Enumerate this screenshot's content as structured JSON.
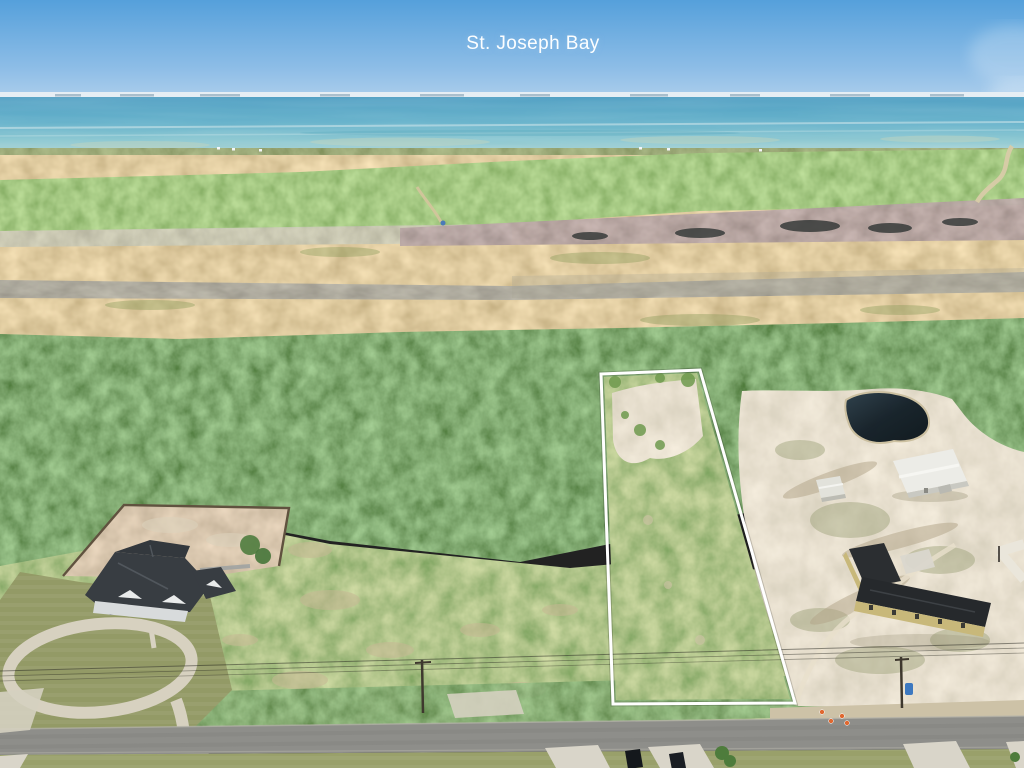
{
  "labels": {
    "bay": "St. Joseph Bay"
  },
  "scene": {
    "type": "aerial-drone-photograph",
    "subject": "Vacant wooded lot outlined in white beside a residential road near St. Joseph Bay",
    "features": [
      "sky",
      "haze-cloud",
      "distant-shoreline",
      "bay-water",
      "shallow-flats",
      "golden-marsh",
      "burned-marsh-band",
      "pine-forest",
      "scrub-field",
      "outlined-parcel",
      "cleared-sand-patch",
      "retention-pond",
      "white-metal-barn",
      "small-shed",
      "tan-outbuilding",
      "house-with-circular-driveway",
      "fenced-dirt-yard",
      "paved-road",
      "driveway-aprons",
      "parked-cars",
      "power-lines",
      "utility-poles",
      "traffic-cones",
      "blue-barrel"
    ]
  },
  "palette": {
    "sky_top": "#55A0DB",
    "sky_horizon": "#AECFEC",
    "water_deep": "#4E9EC2",
    "water_shallow": "#A9D2D3",
    "marsh_gold": "#C9A86B",
    "forest_green": "#46773A",
    "field_green": "#7FA758",
    "sand": "#CEC2A5",
    "road_asphalt": "#8E8E8A",
    "concrete": "#D8D3C4",
    "roof_dark": "#33373C",
    "tan_wall": "#C8B87A",
    "parcel_outline": "#FFFFFF",
    "label_text": "#FCFEFF"
  }
}
